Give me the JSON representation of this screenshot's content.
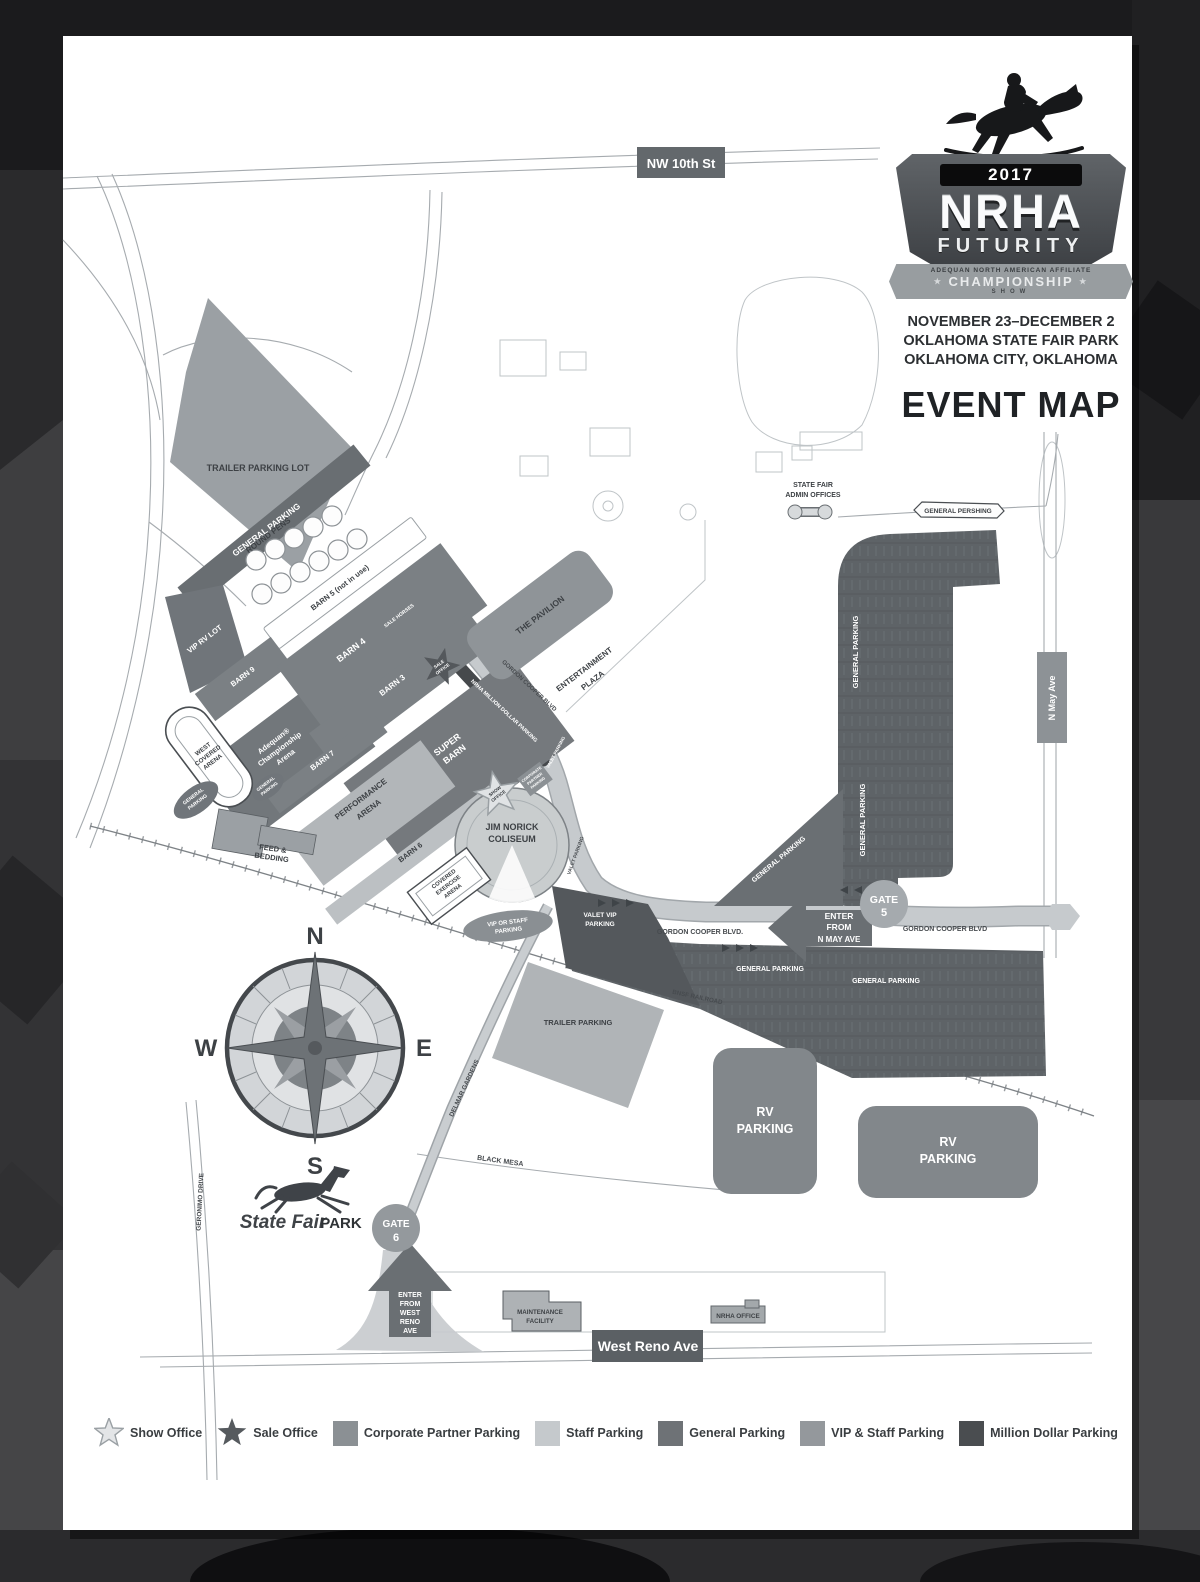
{
  "page": {
    "header": {
      "year": "2017",
      "org": "NRHA",
      "event": "FUTURITY",
      "affiliate": "ADEQUAN NORTH AMERICAN AFFILIATE",
      "championship": "CHAMPIONSHIP",
      "show_word": "SHOW",
      "star": "★",
      "date_range": "NOVEMBER 23–DECEMBER 2",
      "venue": "OKLAHOMA STATE FAIR PARK",
      "city": "OKLAHOMA CITY, OKLAHOMA",
      "map_title": "EVENT MAP"
    },
    "roads": {
      "nw_10th": "NW 10th St",
      "general_pershing": "GENERAL PERSHING",
      "n_may_ave": "N May Ave",
      "gordon_cooper_diagonal": "GORDON COOPER BLVD",
      "gordon_cooper_west": "GORDON COOPER BLVD.",
      "gordon_cooper_east": "GORDON COOPER BLVD",
      "bnsf_railroad": "BNSF RAILROAD",
      "west_reno_ave": "West Reno Ave",
      "geronimo_drive": "GERONIMO DRIVE",
      "delmar_gardens": "DELMAR GARDENS",
      "black_mesa": "BLACK MESA"
    },
    "areas": {
      "trailer_parking_lot": "TRAILER PARKING LOT",
      "general_parking_band": "GENERAL PARKING",
      "round_pens": "ROUND PENS",
      "barn5": "BARN 5 (not in use)",
      "vip_rv_lot": "VIP RV LOT",
      "barn9": "BARN 9",
      "adequan_1": "Adequan®",
      "adequan_2": "Championship",
      "adequan_3": "Arena",
      "barn4": "BARN 4",
      "barn4_sub": "SALE HORSES",
      "barn3": "BARN 3",
      "super_barn_1": "SUPER",
      "super_barn_2": "BARN",
      "barn7": "BARN 7",
      "performance_1": "PERFORMANCE",
      "performance_2": "ARENA",
      "barn6": "BARN 6",
      "west_covered_1": "WEST",
      "west_covered_2": "COVERED",
      "west_covered_3": "ARENA",
      "covered_exercise_1": "COVERED",
      "covered_exercise_2": "EXERCISE",
      "covered_exercise_3": "ARENA",
      "gp_small_1a": "GENERAL",
      "gp_small_1b": "PARKING",
      "gp_small_2a": "GENERAL",
      "gp_small_2b": "PARKING",
      "feed_1": "FEED &",
      "feed_2": "BEDDING",
      "coliseum_1": "JIM NORICK",
      "coliseum_2": "COLISEUM",
      "show_office_1": "SHOW",
      "show_office_2": "OFFICE",
      "sale_office_1": "SALE",
      "sale_office_2": "OFFICE",
      "corp_1": "CORPORATE",
      "corp_2": "PARTNER",
      "corp_3": "PARKING",
      "million_strip": "NRHA MILLION DOLLAR PARKING",
      "valet_parking_upper": "VALET PARKING",
      "valet_parking_side": "VALET PARKING",
      "vip_staff_1": "VIP OR STAFF",
      "vip_staff_2": "PARKING",
      "valet_vip_1": "VALET VIP",
      "valet_vip_2": "PARKING",
      "pavilion": "THE PAVILION",
      "entertainment_1": "ENTERTAINMENT",
      "entertainment_2": "PLAZA",
      "admin_1": "STATE FAIR",
      "admin_2": "ADMIN OFFICES",
      "gp_triangle": "GENERAL PARKING",
      "gp_vert_1": "GENERAL PARKING",
      "gp_vert_2": "GENERAL PARKING",
      "gp_south_1": "GENERAL PARKING",
      "gp_south_2": "GENERAL PARKING",
      "trailer_mid": "TRAILER PARKING",
      "rv_1a": "RV",
      "rv_1b": "PARKING",
      "rv_2a": "RV",
      "rv_2b": "PARKING",
      "maintenance_1": "MAINTENANCE",
      "maintenance_2": "FACILITY",
      "nrha_office": "NRHA OFFICE"
    },
    "gates": {
      "gate5_word": "GATE",
      "gate5_num": "5",
      "gate6_word": "GATE",
      "gate6_num": "6"
    },
    "arrows": {
      "n_may_1": "ENTER",
      "n_may_2": "FROM",
      "n_may_3": "N MAY AVE",
      "west_reno_1": "ENTER",
      "west_reno_2": "FROM",
      "west_reno_3": "WEST",
      "west_reno_4": "RENO",
      "west_reno_5": "AVE"
    },
    "compass": {
      "n": "N",
      "e": "E",
      "s": "S",
      "w": "W"
    },
    "park_logo": {
      "script": "State Fair",
      "bold": "PARK"
    },
    "legend": {
      "show_office": "Show Office",
      "sale_office": "Sale Office",
      "corporate": "Corporate Partner Parking",
      "staff": "Staff Parking",
      "general": "General Parking",
      "vip_staff": "VIP & Staff Parking",
      "million": "Million Dollar Parking"
    },
    "colors": {
      "corporate_parking": "#8b9094",
      "staff_parking": "#c5c9cc",
      "general_parking": "#6e7276",
      "vip_staff_parking": "#94989c",
      "million_dollar_parking": "#4a4d50",
      "dark_text": "#3d4145"
    }
  }
}
